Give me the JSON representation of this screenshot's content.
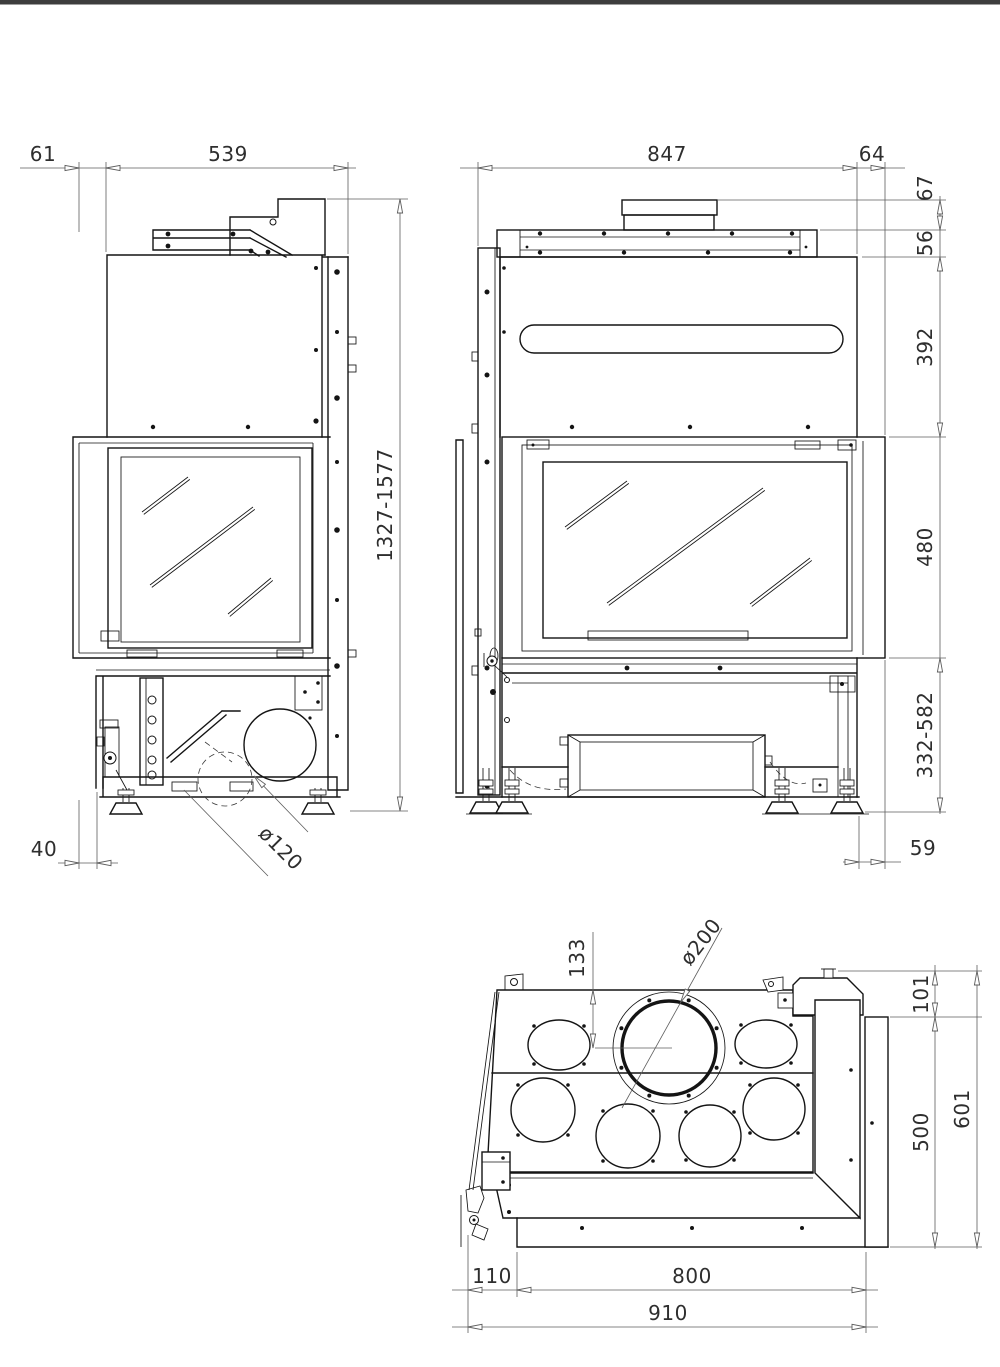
{
  "page": {
    "background": "#ffffff",
    "top_bar_color": "#3d3d3d"
  },
  "drawing": {
    "type": "technical-drawing",
    "subject": "fireplace-insert-three-views",
    "units": "mm",
    "line_color": "#141414",
    "views": {
      "side": {
        "dims": {
          "rear_offset": "61",
          "depth": "539",
          "overall_height_range": "1327-1577",
          "front_clearance": "40",
          "duct_diameter": "ø120"
        }
      },
      "front": {
        "dims": {
          "width": "847",
          "side_return": "64",
          "stub_height": "67",
          "rail_height": "56",
          "upper_body_height": "392",
          "door_height": "480",
          "base_height_range": "332-582",
          "right_clearance": "59"
        }
      },
      "top": {
        "dims": {
          "flue_centre_offset": "133",
          "flue_diameter": "ø200",
          "rear_step_depth": "101",
          "body_depth": "500",
          "overall_depth": "601",
          "left_offset": "110",
          "body_width": "800",
          "overall_width": "910"
        }
      }
    }
  }
}
